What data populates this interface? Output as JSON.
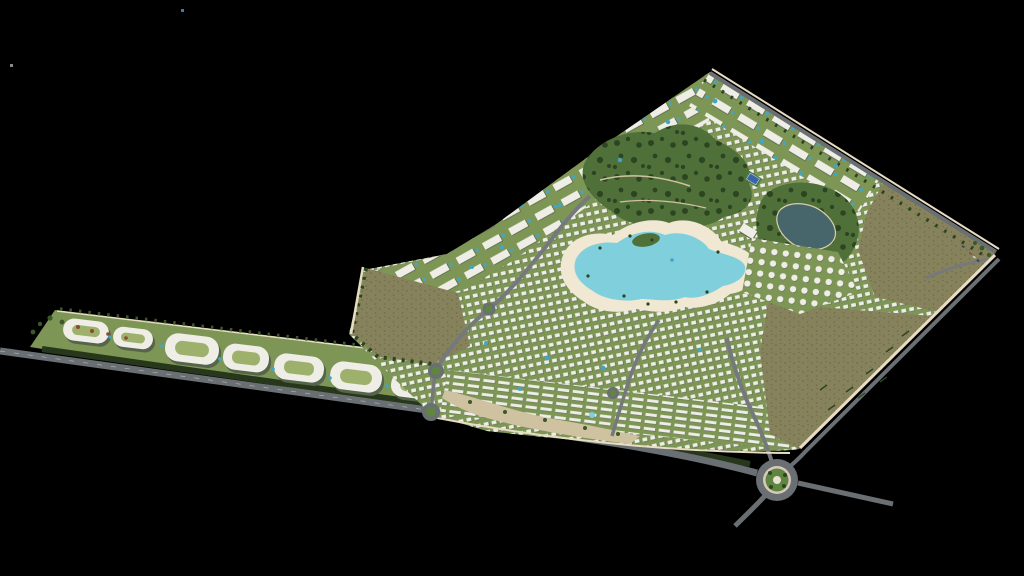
{
  "scene": {
    "type": "aerial-masterplan-render",
    "description": "Bird's-eye 3D render of a kite-shaped resort community on a black background: central swimmable lagoon with sandy beaches, dense white villa fabric, apartment ridges along the boundaries, a landscaped north park with a tennis court, a pond park, three brown farmland/open-land plots, a long linear retail strip extending west, a perimeter wall, boundary roads and several roundabouts including one large landscaped roundabout at the south-east.",
    "visible_text": "none"
  },
  "colors": {
    "background": "#000000",
    "road": "#6a6f73",
    "road_minor": "#75797c",
    "road_marking": "#e8e8e8",
    "hedge": "#26371c",
    "site_green": "#7e9655",
    "park_green": "#50703a",
    "tree_dark": "#2c4520",
    "tree_mid": "#3b5829",
    "field_brown": "#86825c",
    "field_noise": "#6b6746",
    "beach_sand": "#f0e8d3",
    "path_tan": "#cfc2a0",
    "lagoon_water": "#7fd0dc",
    "lagoon_rim": "#b9e7ea",
    "pond_water": "#47666b",
    "building_white": "#eeede6",
    "building_shadow": "#55644a",
    "courtyard_green": "#9db06c",
    "wall_cream": "#e9dcc4",
    "pool_blue": "#3fa6c9",
    "splash_blue": "#7fd0dc",
    "court_blue": "#3b64a8",
    "court_surround": "#4a7a3c",
    "roundabout_green": "#5f8540",
    "roundabout_ring": "#d9c9bb",
    "monument_white": "#e8e2d4",
    "accent_rust": "#8a4a2e",
    "car_dark": "#35424e",
    "artifact_blue": "#3a7abf",
    "artifact_gray": "#8a8a8a"
  },
  "site": {
    "shape": "kite-shaped parcel with a long linear strip extending to the west",
    "districts": [
      "retail-strip-west",
      "northwest-apartment-ridge",
      "northeast-apartment-ridge",
      "central-villa-fabric",
      "domed-villa-rows-east",
      "terraced-rows-south"
    ],
    "amenities": [
      "central-lagoon",
      "sandy-beach",
      "north-park",
      "tennis-court",
      "pond-park",
      "swimming-pools",
      "splash-pad",
      "clubhouse"
    ],
    "open_land": [
      "west-farmland",
      "northeast-farmland",
      "southeast-farmland"
    ],
    "infrastructure": {
      "roundabouts": 5,
      "strip_buildings": 7,
      "perimeter_wall": true,
      "boundary_roads": [
        "northeast-boundary-road",
        "southeast-boundary-road",
        "southwest-main-road"
      ]
    }
  }
}
